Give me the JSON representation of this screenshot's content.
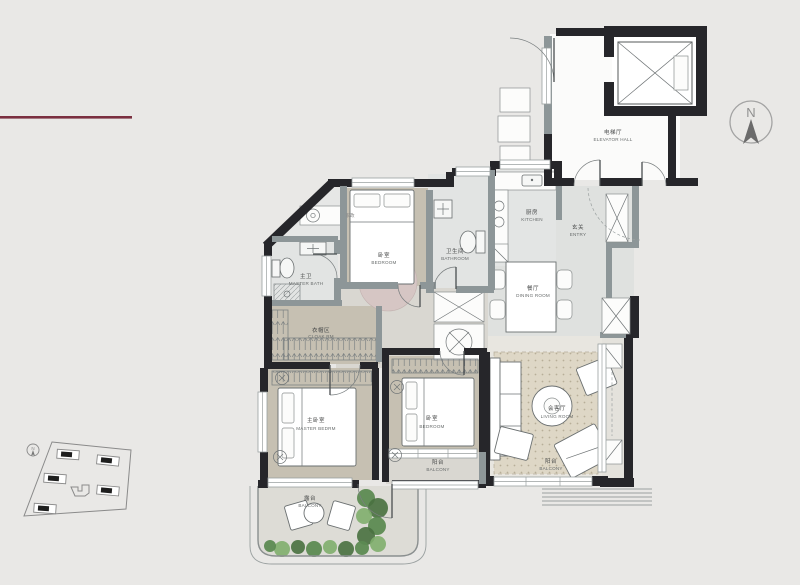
{
  "colors": {
    "page_bg": "#e9e8e6",
    "wall": "#26262a",
    "wall_gray": "#8d9698",
    "floor_warm": "#c6c0b2",
    "floor_wet": "#e2e4e3",
    "floor_light": "#dfe1df",
    "floor_corridor": "#d9d7d1",
    "rug_living": "#ded7c6",
    "rug_pink": "#d6c6c4",
    "plant_green": "#5c8a52",
    "accent_line": "#7b3040",
    "site_line": "#8a8a8a"
  },
  "compass": {
    "label": "N"
  },
  "site_plan": {
    "compass_label": "N"
  },
  "rooms": {
    "elevator_hall": {
      "zh": "电梯厅",
      "en": "ELEVATOR HALL"
    },
    "kitchen": {
      "zh": "厨房",
      "en": "KITCHEN"
    },
    "entry": {
      "zh": "玄关",
      "en": "ENTRY"
    },
    "dining_room": {
      "zh": "餐厅",
      "en": "DINING ROOM"
    },
    "bathroom": {
      "zh": "卫生间",
      "en": "BATHROOM"
    },
    "bedroom_top": {
      "zh": "卧室",
      "en": "BEDROOM"
    },
    "master_bath": {
      "zh": "主卫",
      "en": "MASTER BATH"
    },
    "housekeeping": {
      "zh": "家政",
      "en": ""
    },
    "cloak_room": {
      "zh": "衣帽区",
      "en": "CLOAK RM"
    },
    "master_bedroom": {
      "zh": "主卧室",
      "en": "MASTER BEDRM"
    },
    "bedroom_2": {
      "zh": "卧室",
      "en": "BEDROOM"
    },
    "bedroom_balcony": {
      "zh": "阳台",
      "en": "BALCONY"
    },
    "living_room": {
      "zh": "会客厅",
      "en": "LIVING ROOM"
    },
    "living_balcony": {
      "zh": "阳台",
      "en": "BALCONY"
    },
    "terrace": {
      "zh": "露台",
      "en": "BALCONY"
    }
  }
}
